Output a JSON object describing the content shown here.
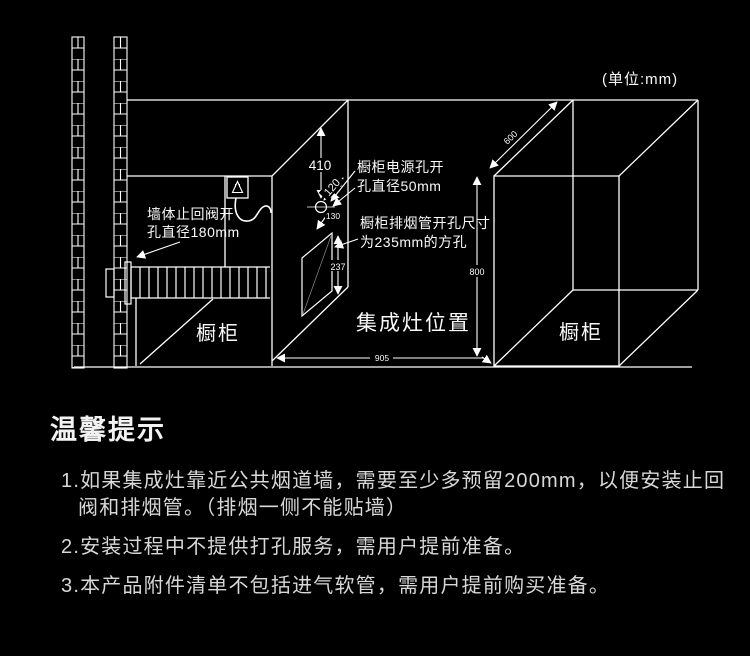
{
  "colors": {
    "background": "#000000",
    "line": "#ffffff",
    "diagram_text": "#fafafa",
    "tips_text": "#d8d8d8",
    "tips_title_text": "#f2f2f2"
  },
  "diagram": {
    "unit_note": "(单位:mm)",
    "labels": {
      "wall_valve_line1": "墙体止回阀开",
      "wall_valve_line2": "孔直径180mm",
      "power_hole_line1": "橱柜电源孔开",
      "power_hole_line2": "孔直径50mm",
      "smoke_hole_line1": "橱柜排烟管开孔尺寸",
      "smoke_hole_line2": "为235mm的方孔",
      "cabinet_left": "橱柜",
      "cabinet_right": "橱柜",
      "stove_position": "集成灶位置"
    },
    "dimensions": {
      "hole_top_offset": "410",
      "hole_edge_offset": "120",
      "hole_gap": "130",
      "square_hole_size": "237",
      "cabinet_height": "800",
      "cabinet_depth": "600",
      "stove_width": "905"
    }
  },
  "tips": {
    "title": "温馨提示",
    "items": [
      {
        "lines": [
          "1.如果集成灶靠近公共烟道墙，需要至少多预留200mm，以便安装止回",
          "阀和排烟管。（排烟一侧不能贴墙）"
        ]
      },
      {
        "lines": [
          "2.安装过程中不提供打孔服务，需用户提前准备。"
        ]
      },
      {
        "lines": [
          "3.本产品附件清单不包括进气软管，需用户提前购买准备。"
        ]
      }
    ]
  }
}
